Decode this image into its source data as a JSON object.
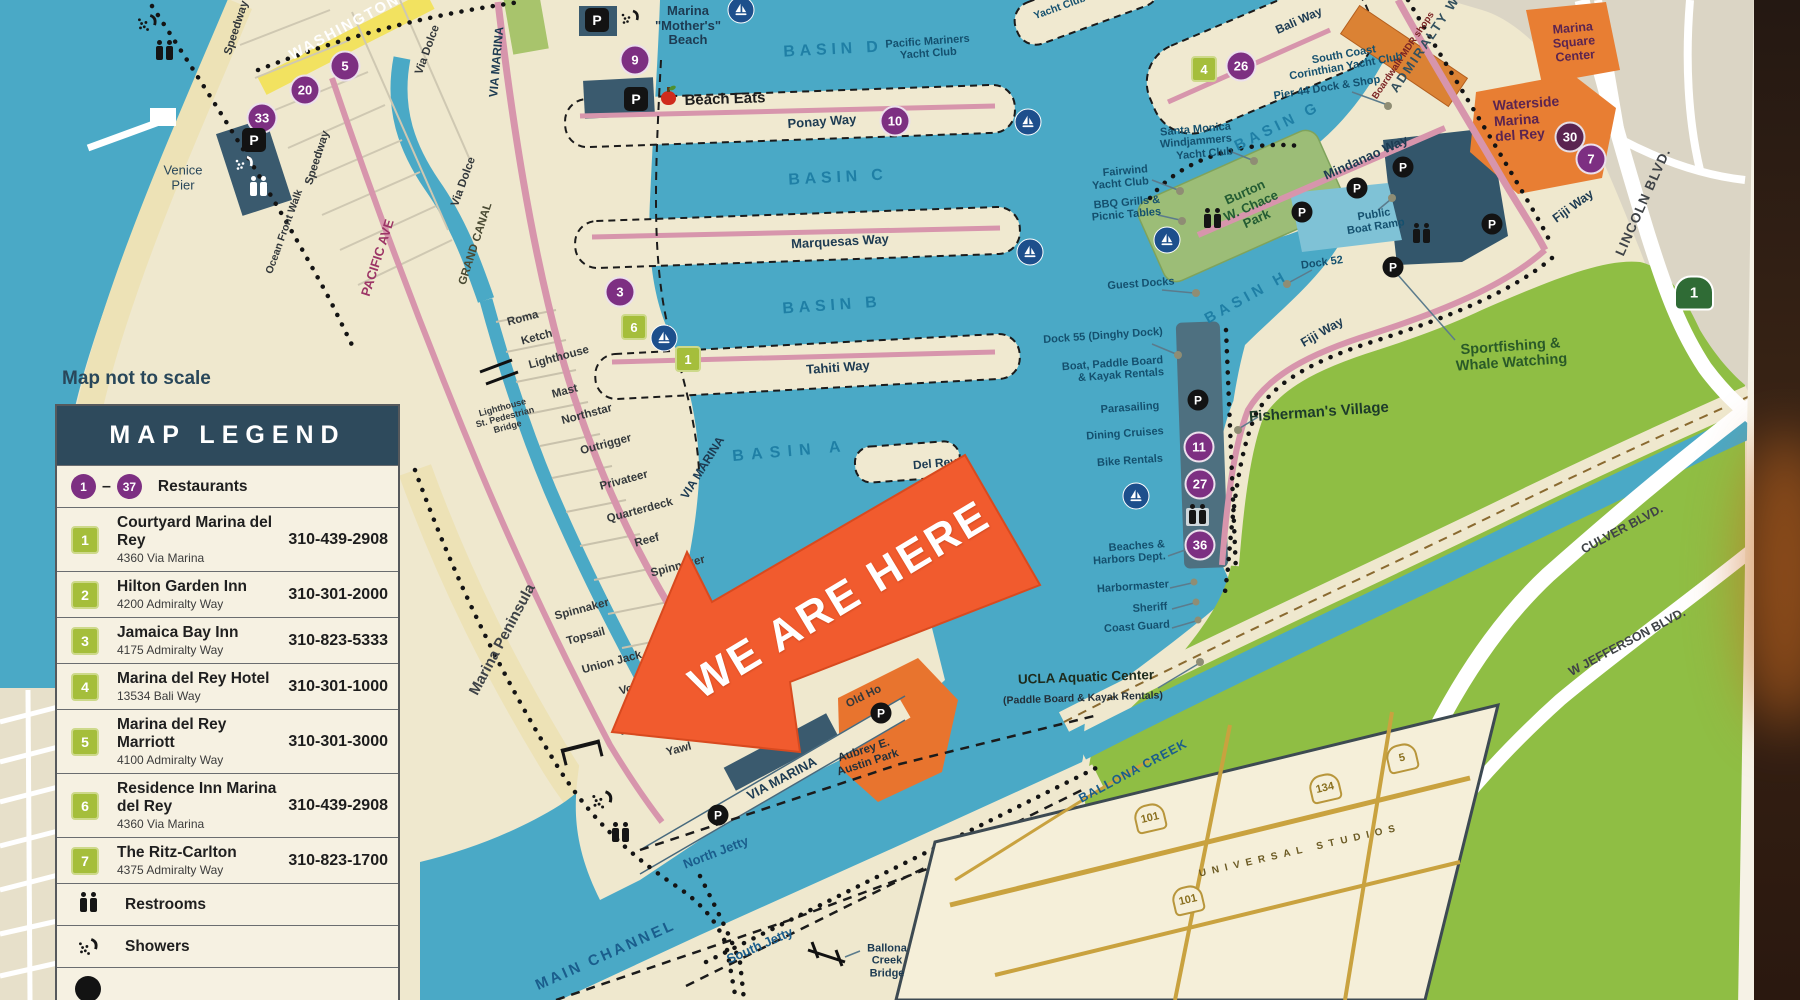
{
  "legend": {
    "scale_note": "Map not to scale",
    "title": "MAP LEGEND",
    "restaurants": {
      "from": "1",
      "dash": "–",
      "to": "37",
      "label": "Restaurants"
    },
    "entries": [
      {
        "num": "1",
        "name": "Courtyard Marina del Rey",
        "address": "4360 Via Marina",
        "phone": "310-439-2908"
      },
      {
        "num": "2",
        "name": "Hilton Garden Inn",
        "address": "4200 Admiralty Way",
        "phone": "310-301-2000"
      },
      {
        "num": "3",
        "name": "Jamaica Bay Inn",
        "address": "4175 Admiralty Way",
        "phone": "310-823-5333"
      },
      {
        "num": "4",
        "name": "Marina del Rey Hotel",
        "address": "13534 Bali Way",
        "phone": "310-301-1000"
      },
      {
        "num": "5",
        "name": "Marina del Rey Marriott",
        "address": "4100 Admiralty Way",
        "phone": "310-301-3000"
      },
      {
        "num": "6",
        "name": "Residence Inn Marina del Rey",
        "address": "4360 Via Marina",
        "phone": "310-439-2908"
      },
      {
        "num": "7",
        "name": "The Ritz-Carlton",
        "address": "4375 Admiralty Way",
        "phone": "310-823-1700"
      }
    ],
    "amenities": [
      {
        "label": "Restrooms"
      },
      {
        "label": "Showers"
      }
    ]
  },
  "arrow": {
    "text": "WE ARE HERE"
  },
  "map": {
    "basins": {
      "d": "BASIN D",
      "c": "BASIN C",
      "b": "BASIN B",
      "a": "BASIN A",
      "g": "BASIN G",
      "h": "BASIN H"
    },
    "streets": {
      "washington": "WASHINGTON",
      "speedway": "Speedway",
      "via_dolce": "Via Dolce",
      "pacific_ave": "PACIFIC AVE",
      "grand_canal": "GRAND CANAL",
      "ocean_front_walk": "Ocean Front Walk",
      "via_marina": "VIA MARINA",
      "marina_peninsula": "Marina Peninsula",
      "roma": "Roma",
      "ketch": "Ketch",
      "lighthouse": "Lighthouse",
      "mast": "Mast",
      "northstar": "Northstar",
      "outrigger": "Outrigger",
      "privateer": "Privateer",
      "quarterdeck": "Quarterdeck",
      "reef": "Reef",
      "spinnaker": "Spinnaker",
      "topsail": "Topsail",
      "union_jack": "Union Jack",
      "voyage": "Voyage",
      "westwind": "Westwind",
      "yawl": "Yawl",
      "ponay_way": "Ponay Way",
      "marquesas_way": "Marquesas Way",
      "tahiti_way": "Tahiti Way",
      "bali_way": "Bali Way",
      "mindanao_way": "Mindanao Way",
      "admiralty_way": "ADMIRALTY WAY",
      "fiji_way": "Fiji Way",
      "lincoln_blvd": "LINCOLN BLVD.",
      "culver_blvd": "CULVER BLVD.",
      "w_jefferson_blvd": "W JEFFERSON BLVD.",
      "del_rey": "Del Rey",
      "old_ho": "Old Ho"
    },
    "places": {
      "venice_pier": "Venice\nPier",
      "mothers_beach": "Marina\n\"Mother's\"\nBeach",
      "beach_eats": "Beach Eats",
      "pacific_mariners": "Pacific Mariners\nYacht Club",
      "smwyc": "Santa Monica\nWindjammers\nYacht Club",
      "fairwind": "Fairwind\nYacht Club",
      "chace_park": "Burton\nW. Chace\nPark",
      "bbq": "BBQ Grills &\nPicnic Tables",
      "guest_docks": "Guest Docks",
      "dock52": "Dock 52",
      "dock55": "Dock 55 (Dinghy Dock)",
      "boat_rentals": "Boat, Paddle Board\n& Kayak Rentals",
      "parasailing": "Parasailing",
      "dining_cruises": "Dining Cruises",
      "bike_rentals": "Bike Rentals",
      "beaches_harbors": "Beaches &\nHarbors Dept.",
      "harbormaster": "Harbormaster",
      "sheriff": "Sheriff",
      "coast_guard": "Coast Guard",
      "fishermans_village": "Fisherman's Village",
      "sportfishing": "Sportfishing &\nWhale Watching",
      "sccyc": "South Coast\nCorinthian Yacht Club",
      "pier44": "Pier 44 Dock & Shop",
      "boardwalk": "Boardwalk MDR shops",
      "marina_square": "Marina\nSquare\nCenter",
      "waterside": "Waterside\nMarina\ndel Rey",
      "yacht_club": "Yacht Club",
      "public_boat_ramp": "Public\nBoat Ramp",
      "ucla": "UCLA Aquatic Center",
      "ucla_sub": "(Paddle Board & Kayak Rentals)",
      "aubrey_park": "Aubrey E.\nAustin Park",
      "ballona_bridge": "Ballona\nCreek\nBridge",
      "lighthouse_bridge": "Lighthouse\nSt. Pedestrian\nBridge",
      "universal": "UNIVERSAL STUDIOS",
      "north_jetty": "North Jetty",
      "south_jetty": "South Jetty",
      "main_channel": "MAIN CHANNEL",
      "ballona_creek": "BALLONA CREEK"
    },
    "markers": {
      "p": "P",
      "r5": "5",
      "r20": "20",
      "r33": "33",
      "r9": "9",
      "r10": "10",
      "r3": "3",
      "r26": "26",
      "r30": "30",
      "r7": "7",
      "r11": "11",
      "r27": "27",
      "r36": "36",
      "h1": "1",
      "h4": "4",
      "h6": "6",
      "hwy1": "1",
      "i101": "101",
      "i134": "134",
      "i5": "5"
    }
  }
}
